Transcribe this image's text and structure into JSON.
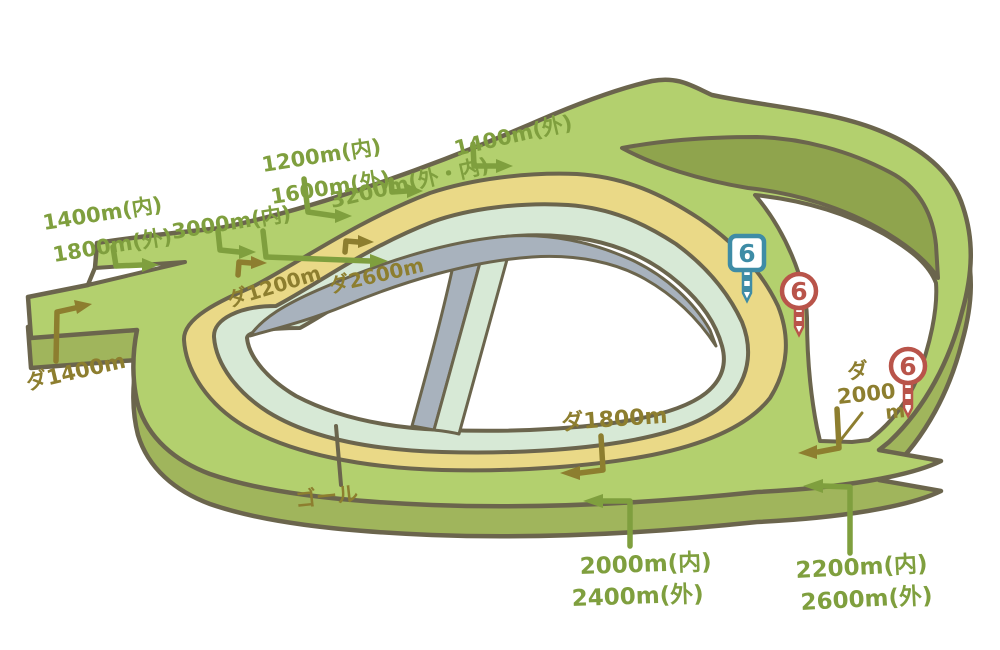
{
  "illustration": {
    "type": "racecourse-track-map",
    "background": "#ffffff",
    "colors": {
      "outline": "#6b654d",
      "turf_green": "#b3d06e",
      "side_green": "#a0b55c",
      "infield_wedge_green": "#8fa44d",
      "dirt_yellow": "#ead987",
      "jump_mint": "#d7e9d6",
      "hedge_gray": "#a8b2bd",
      "turf_label_green": "#7f9f3e",
      "dirt_label_olive": "#8d7e2f",
      "marker_blue": "#3e8ca6",
      "marker_red": "#b9544a"
    },
    "labels": {
      "turf_1400_inner": "1400m(内)",
      "turf_1800_outer": "1800m(外)",
      "turf_3000_inner": "3000m(内)",
      "turf_1200_inner": "1200m(内)",
      "turf_1600_outer": "1600m(外)",
      "turf_3200_outer_inner": "3200m(外・内)",
      "turf_1400_outer": "1400m(外)",
      "turf_2000_inner": "2000m(内)",
      "turf_2400_outer": "2400m(外)",
      "turf_2200_inner": "2200m(内)",
      "turf_2600_outer": "2600m(外)",
      "dirt_1400": "ダ1400m",
      "dirt_1200": "ダ1200m",
      "dirt_2600": "ダ2600m",
      "dirt_1800": "ダ1800m",
      "dirt_2000_kana": "ダ",
      "dirt_2000_num": "2000",
      "dirt_2000_unit": "m",
      "goal": "ゴール",
      "furlong_6": "6"
    }
  }
}
